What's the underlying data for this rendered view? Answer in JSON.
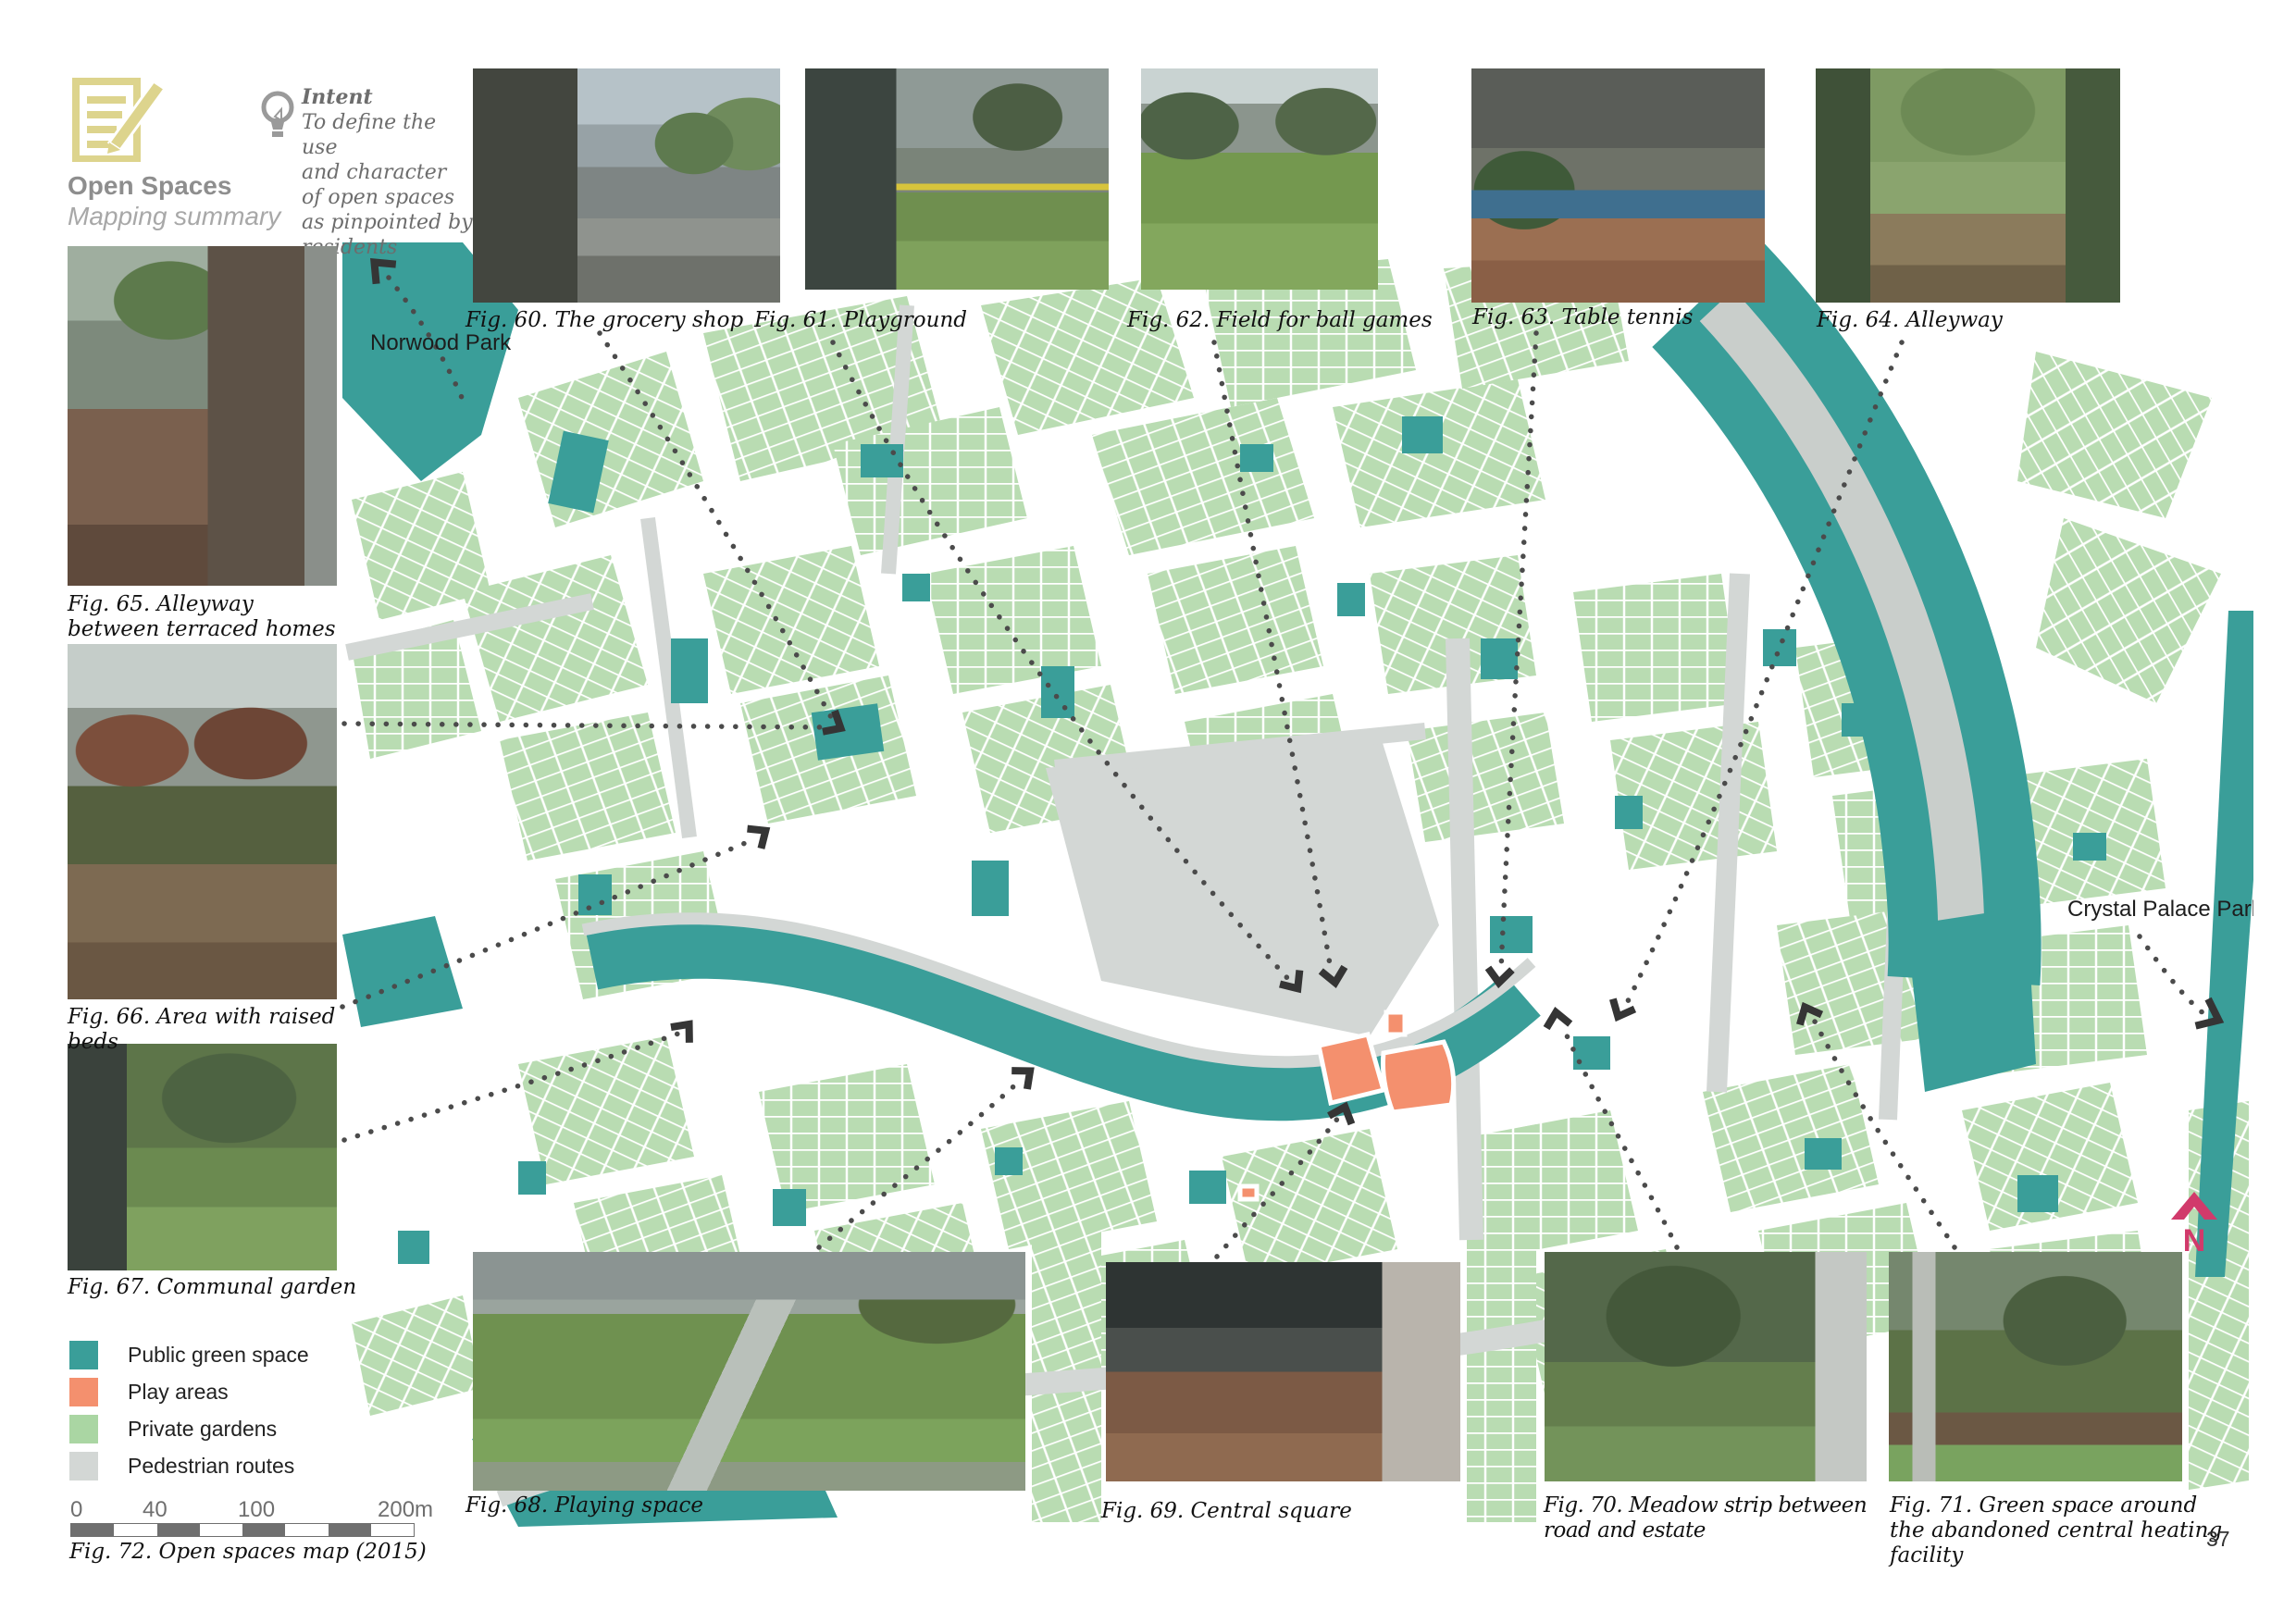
{
  "header": {
    "title": "Open Spaces",
    "subtitle": "Mapping summary",
    "icon": "notepad-pencil-icon",
    "icon_color": "#ddd48d"
  },
  "intent": {
    "icon": "lightbulb-icon",
    "heading": "Intent",
    "lines": [
      "To define the use",
      "and character",
      "of open spaces",
      "as pinpointed by",
      "residents"
    ]
  },
  "figures": {
    "top": [
      "Fig. 60. The grocery shop",
      "Fig. 61. Playground",
      "Fig. 62. Field for ball games",
      "Fig. 63. Table tennis",
      "Fig. 64. Alleyway"
    ],
    "left": [
      "Fig. 65. Alleyway between terraced homes",
      "Fig. 66. Area with raised beds",
      "Fig. 67. Communal garden"
    ],
    "bottom": [
      "Fig. 68. Playing space",
      "Fig. 69. Central square",
      "Fig. 70. Meadow strip between road and estate",
      "Fig. 71. Green space around the abandoned central heating facility"
    ]
  },
  "map": {
    "caption": "Fig. 72. Open spaces map (2015)",
    "labels": {
      "norwood": "Norwood Park",
      "crystal": "Crystal Palace Park"
    },
    "north_letter": "N",
    "north_color": "#d13a6b",
    "legend": [
      {
        "label": "Public green space",
        "color": "#3a9e99"
      },
      {
        "label": "Play areas",
        "color": "#f4906e"
      },
      {
        "label": "Private gardens",
        "color": "#aad6a3"
      },
      {
        "label": "Pedestrian routes",
        "color": "#d3d7d5"
      }
    ],
    "scalebar": {
      "ticks": [
        "0",
        "40",
        "100",
        "200m"
      ]
    }
  },
  "page": {
    "number": "37"
  }
}
